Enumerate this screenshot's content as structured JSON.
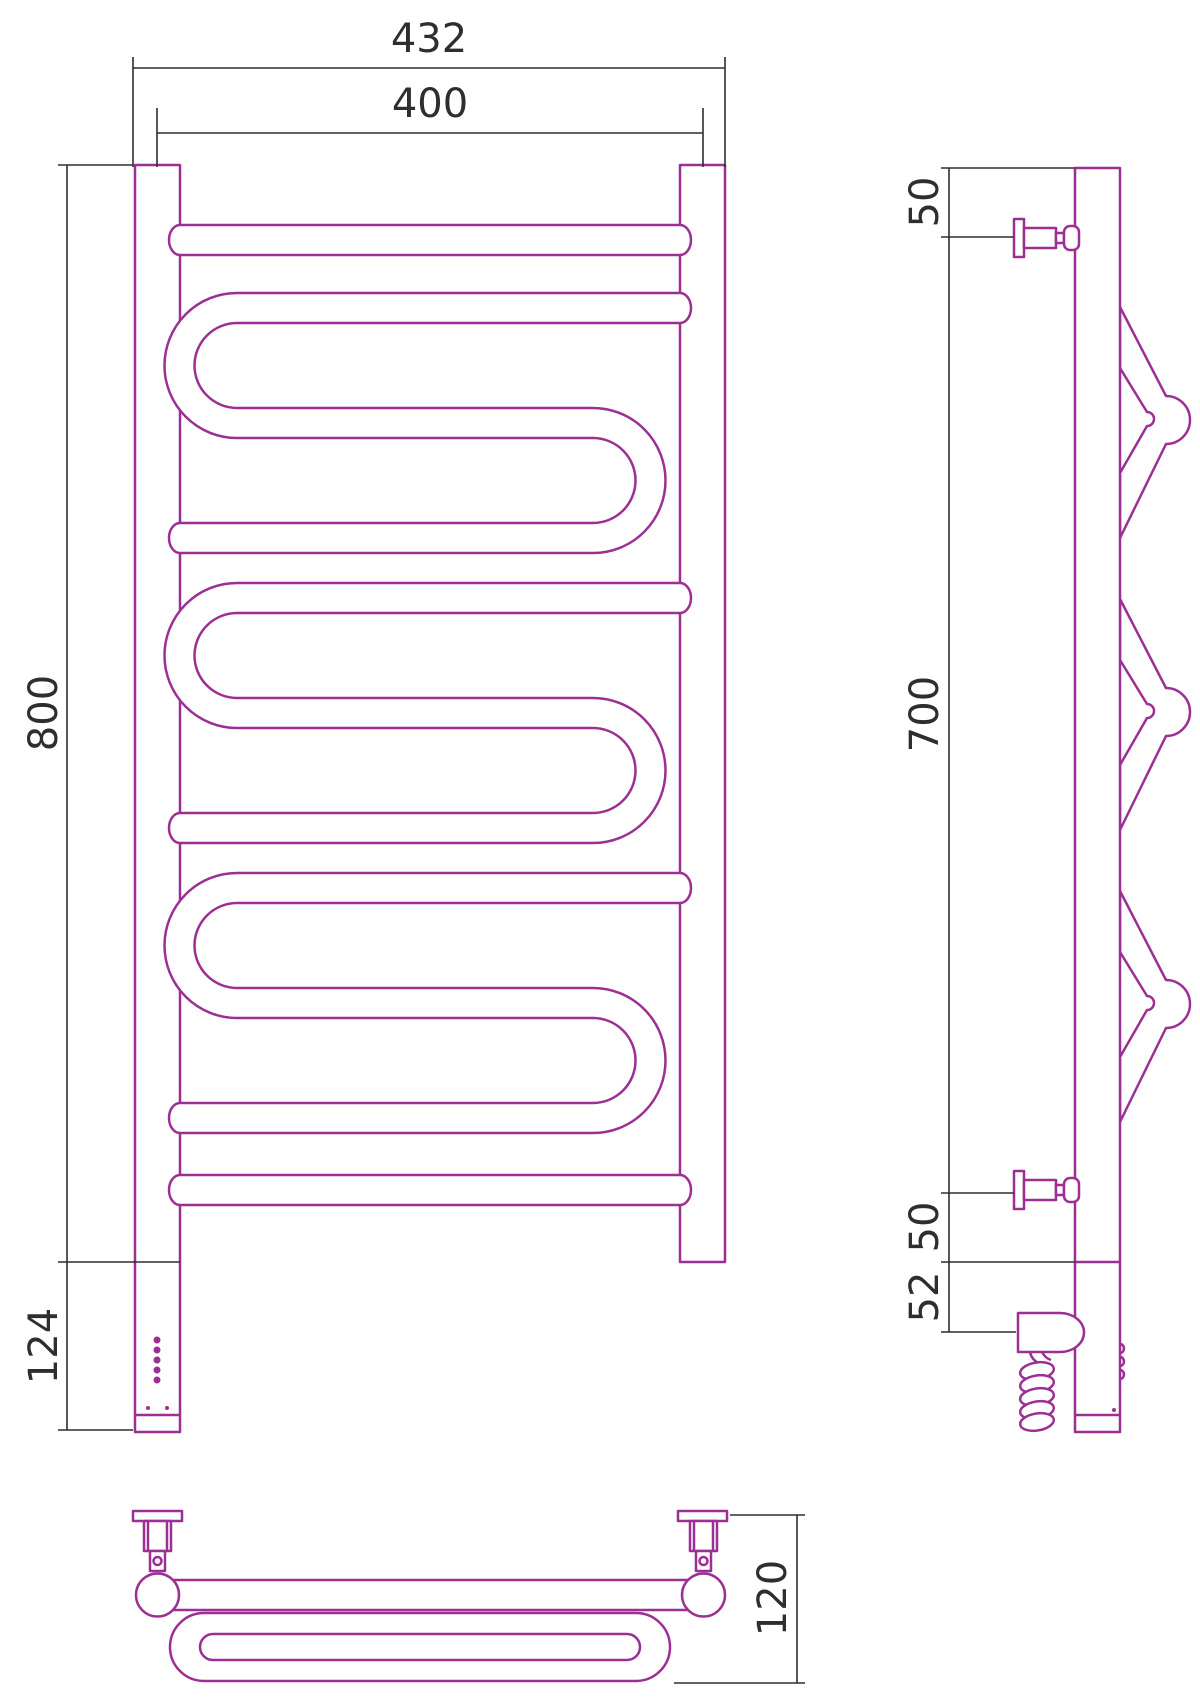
{
  "drawing": {
    "accent_color": "#9C2F94",
    "dimension_color": "#2e2e2e",
    "background_color": "#ffffff",
    "front_view": {
      "overall_width": "432",
      "mount_width": "400",
      "height": "800",
      "control_height": "124"
    },
    "side_view": {
      "top_bracket_offset": "50",
      "bracket_span": "700",
      "bottom_bracket_offset": "50",
      "heater_offset": "52"
    },
    "plan_view": {
      "depth": "120"
    }
  }
}
